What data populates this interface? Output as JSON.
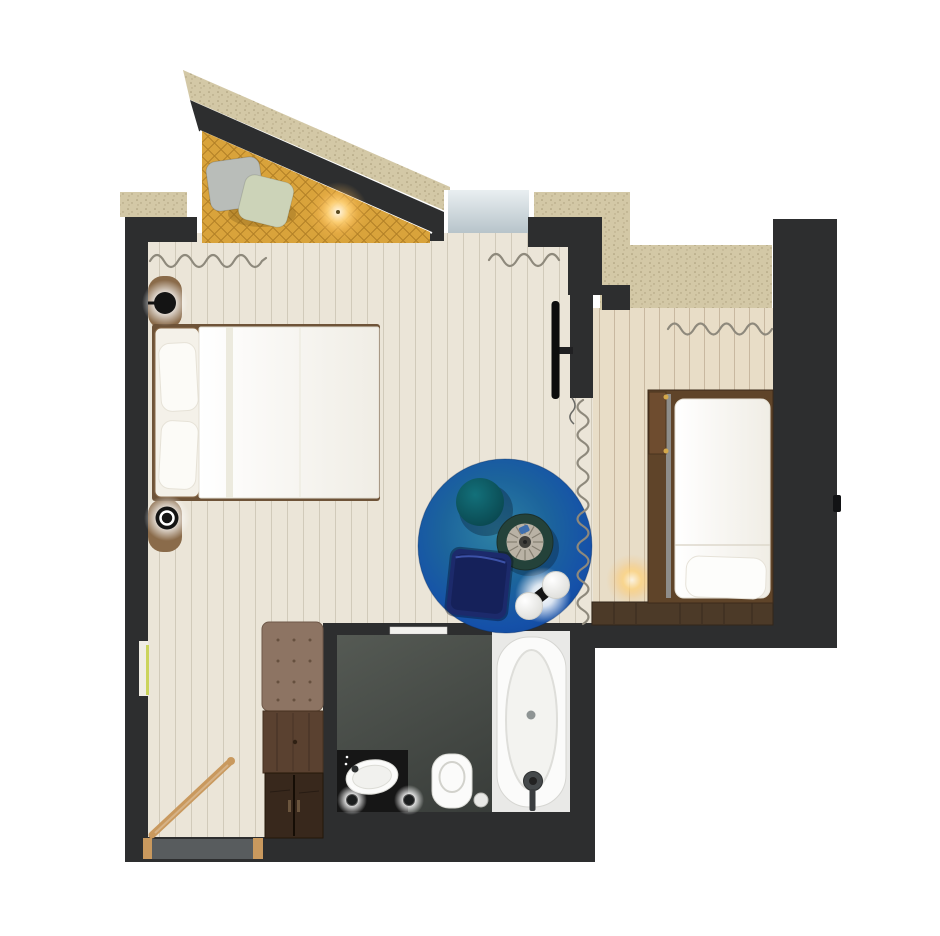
{
  "meta": {
    "title": "apartment-floor-plan",
    "image_type": "top-down rendered floor plan of a hotel suite",
    "has_visible_text": false
  },
  "colors": {
    "wall": "#2d2e2f",
    "exterior_wall": "#d3c8a6",
    "floor_main": "#ebe5d8",
    "floor_right": "#e8ddc7",
    "plank_line": "rgba(150,138,115,0.30)",
    "bay_mattress": "#d9a33b",
    "quilt_line": "rgba(120,75,8,0.40)",
    "rug_outer": "#12479a",
    "rug_inner": "#2e82a4",
    "bathroom_floor_dark": "#383c39",
    "bathroom_floor_light": "#555a54",
    "vanity": "#161616",
    "tub_deck": "#e9e9e7",
    "white_fixture": "#fbfbfa",
    "wood_frame": "#5f4429",
    "wood_bench": "#4c3a28",
    "wood_dresser": "#5a4130",
    "wood_wardrobe": "#38281c",
    "ottoman": "#8d7463",
    "railing_oak": "#c9995e",
    "nightstand": "#8a6b4a",
    "curtain_line": "#8e897c",
    "glass_top": "#e9eff1",
    "glass_bottom": "#b7c4ca",
    "light_strip": "#cbd45c",
    "pouf_teal": "#0d525c",
    "pouf_navy": "#15215a",
    "chair_seat": "#b9b2a5",
    "chair_ring": "#24423a",
    "tv": "#0d0d0d",
    "mat": "#585c5e",
    "pillow_gray": "#b9bdb9",
    "pillow_sage": "#ccd3b8",
    "bed_white": "#fdfdfc"
  },
  "rooms": {
    "bay_nook": {
      "label": "sloped bay-window daybed nook",
      "items": [
        "gold-quilted-daybed",
        "gray-pillow",
        "sage-pillow",
        "warm-ceiling-light"
      ]
    },
    "main_bedroom": {
      "label": "main bedroom / living area",
      "items": [
        "double-bed",
        "headboard",
        "two-pillows",
        "two-wall-sconces",
        "two-curved-nightstands",
        "wall-mounted-tv",
        "round-blue-area-rug",
        "teal-round-pouf",
        "swivel-armchair",
        "navy-square-pouf",
        "double-ball-floor-lamp",
        "window-with-curtain",
        "wall-light-strip"
      ]
    },
    "second_bedroom": {
      "label": "single-bed alcove",
      "items": [
        "single-bed-with-wood-frame",
        "fold-hinge-panel",
        "pillow",
        "foot-bench",
        "curtain",
        "warm-floor-light",
        "door-handle"
      ]
    },
    "bathroom": {
      "label": "bathroom",
      "items": [
        "bathtub-with-faucet",
        "toilet",
        "washbasin",
        "dark-vanity-counter",
        "two-spotlights",
        "white-door"
      ]
    },
    "entry": {
      "label": "stair landing entry",
      "items": [
        "wooden-stair-railing",
        "gray-doormat",
        "tufted-ottoman",
        "wood-dresser",
        "wardrobe"
      ]
    }
  }
}
